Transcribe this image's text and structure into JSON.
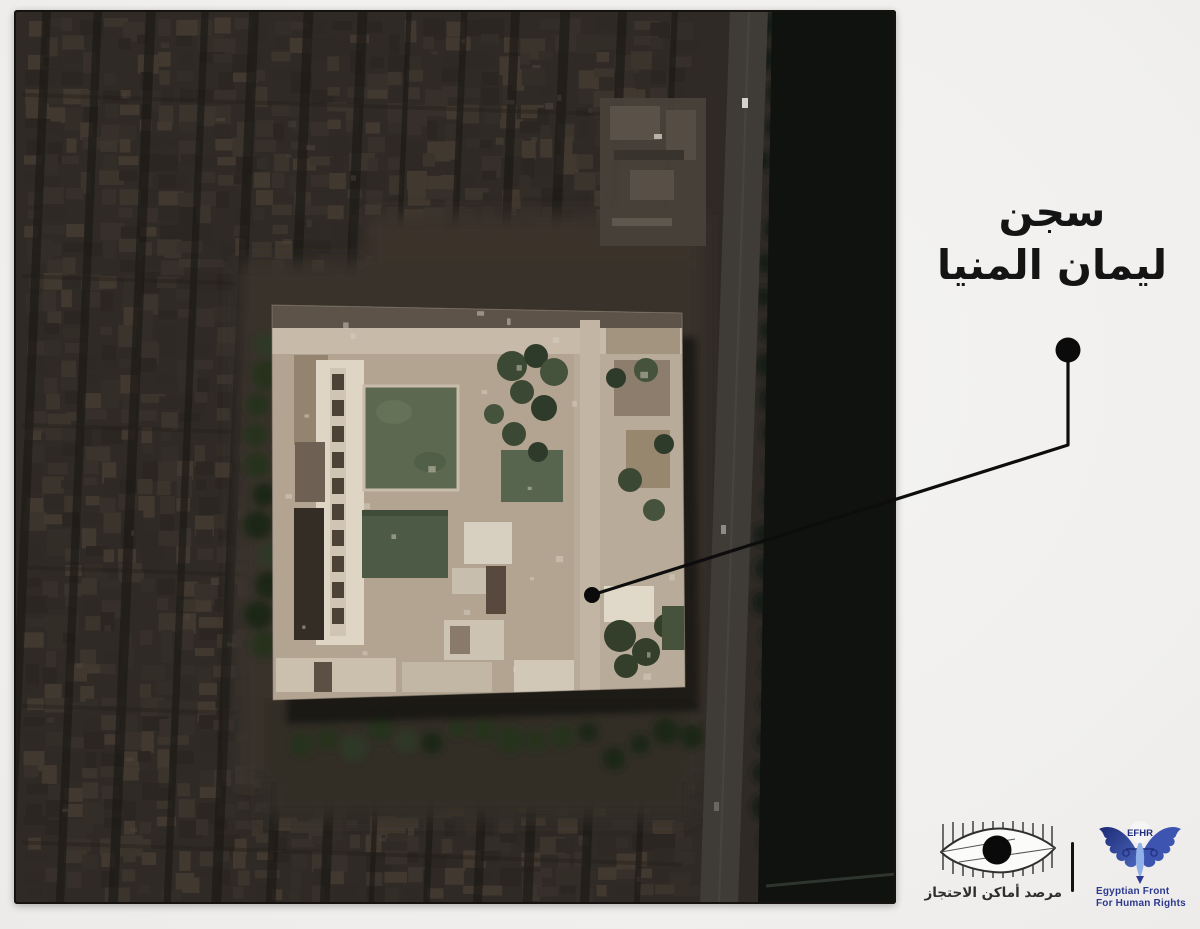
{
  "title": {
    "line1": "سجن",
    "line2": "ليمان المنيا"
  },
  "footer": {
    "observatory": {
      "label": "مرصد أماكن الاحتجاز"
    },
    "efhr": {
      "acronym": "EFHR",
      "line1": "Egyptian Front",
      "line2": "For Human Rights"
    }
  },
  "icons": {
    "observatory_logo": "eye-behind-prison-bars-icon",
    "efhr_logo": "eagle-with-scales-icon",
    "callout_marker": "filled-circle-dot",
    "location_marker": "filled-circle-dot"
  },
  "colors": {
    "page_background": "#f1f0ee",
    "annotation_ink": "#0d0d0d",
    "title_text": "#141414",
    "efhr_navy": "#2b3990",
    "efhr_light_blue": "#8fb0e8",
    "observatory_ink": "#2e2e2e"
  }
}
